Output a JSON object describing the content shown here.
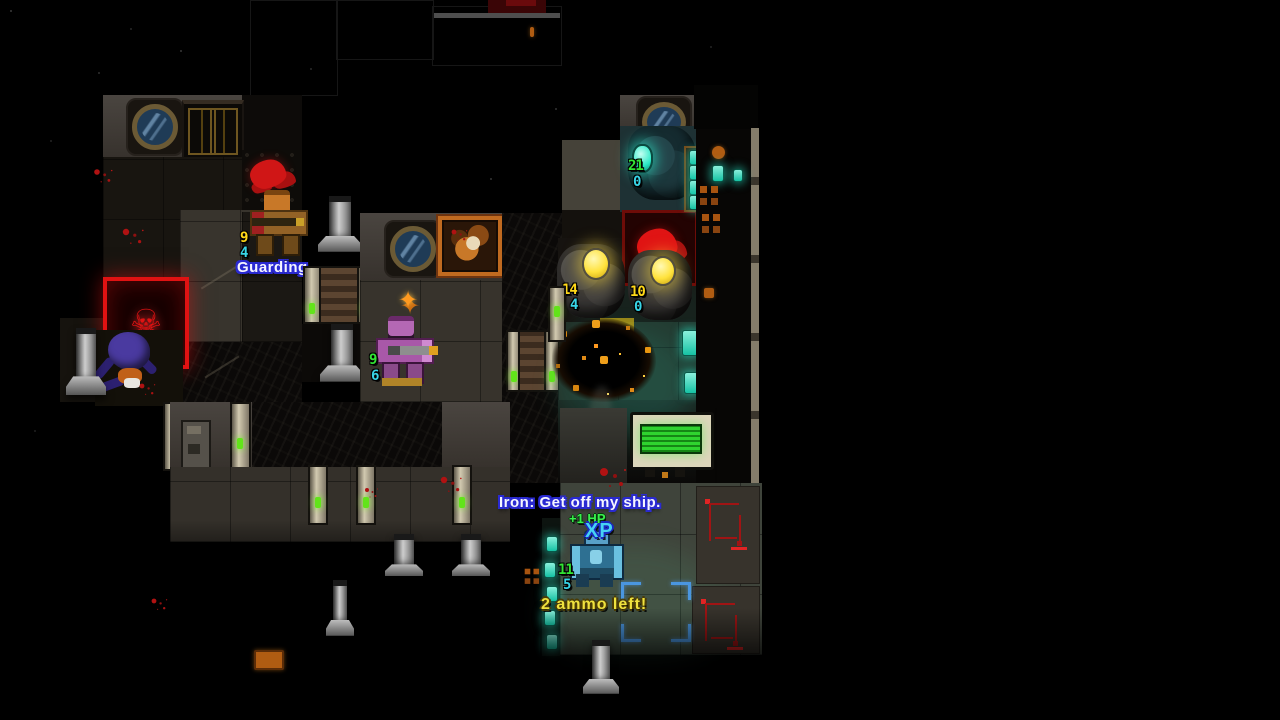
{
  "hud": {
    "status_guarding": "Guarding",
    "speech": "Iron: Get off my ship.",
    "hp_popup": "+1 HP",
    "xp_popup": "XP",
    "ammo_warning": "2 ammo left!"
  },
  "entities": {
    "guard": {
      "label": "guard-soldier",
      "hp": "9",
      "armor": "4"
    },
    "scout": {
      "label": "purple-soldier",
      "hp": "9",
      "armor": "6"
    },
    "rock_robot_1": {
      "label": "rock-robot",
      "hp": "14",
      "armor": "4"
    },
    "rock_robot_2": {
      "label": "rock-robot",
      "hp": "10",
      "armor": "0"
    },
    "drone": {
      "label": "disabled-drone",
      "hp": "21",
      "armor": "0"
    },
    "player": {
      "label": "player-marine",
      "hp": "11",
      "armor": "5"
    }
  },
  "icons": {
    "skull": "☠",
    "spark": "✦"
  },
  "colors": {
    "hp_yellow": "#ffd818",
    "hp_green": "#32e434",
    "armor_cyan": "#38d4e6",
    "ammo_yellow": "#efe23e",
    "popup_green": "#3af04c",
    "xp_cyan": "#46d2f2",
    "speech_white": "#f5f5ff",
    "speech_outline_blue": "#2a2ad2",
    "alert_red": "#e01212",
    "led_green": "#62e41a",
    "teal_light": "#2ae8c6",
    "orb_yellow": "#ffe23c",
    "explosion_orange": "#e08a16"
  }
}
